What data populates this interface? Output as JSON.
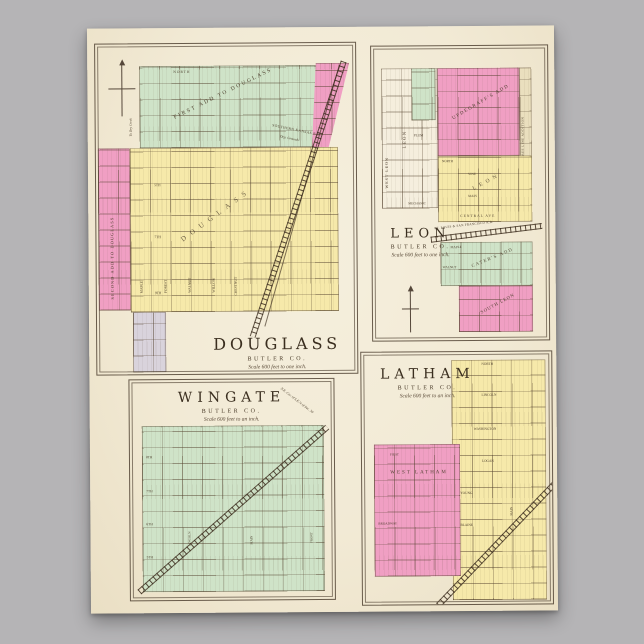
{
  "palette": {
    "background": "#b5b4b6",
    "paper": "#f2ead5",
    "green": "#cfe3c8",
    "yellow": "#f6e9aa",
    "pink": "#f09fc3",
    "lavender": "#d9d3dc",
    "ink": "#5a4a38"
  },
  "poster": {
    "douglass": {
      "title": "DOUGLASS",
      "county": "BUTLER CO.",
      "scale": "Scale 600 feet to one inch.",
      "labels": {
        "first_add": "FIRST ADD TO DOUGLASS",
        "second_add": "SECOND ADD TO DOUGLASS",
        "original": "DOUGLASS",
        "railroad": "SOUTHERN KANSAS R.R.",
        "depot": "Dep. Grounds",
        "north": "NORTH",
        "note": "To Dry Creek"
      },
      "streets": [
        "MAPLE",
        "FOREST",
        "WALNUT",
        "WILLOW",
        "CHESTNUT",
        "5TH",
        "7TH",
        "9TH"
      ]
    },
    "leon": {
      "title": "LEON",
      "county": "BUTLER CO.",
      "scale": "Scale 600 feet to one inch.",
      "labels": {
        "west_leon": "WEST LEON",
        "leon_vertical": "LEON",
        "updegraffs_add": "UPDEGRAFF'S ADD",
        "bee_line": "BEE LINE ADDITION",
        "original": "LEON",
        "caters_add": "CATER'S ADD",
        "south_leon": "SOUTH LEON",
        "railroad": "ST. LOUIS & SAN FRANCISCO R.R."
      },
      "streets": [
        "PLUM",
        "NORTH",
        "VINE",
        "MAIN",
        "MECHANIC",
        "CENTRAL AVE",
        "MAPLE",
        "WALNUT"
      ]
    },
    "wingate": {
      "title": "WINGATE",
      "county": "BUTLER CO.",
      "scale": "Scale 600 feet to an inch.",
      "labels": {
        "corner_note": "N.E. Cor. of S.E.¼ of Sec. 30"
      },
      "streets": [
        "8TH",
        "7TH",
        "6TH",
        "5TH",
        "LINCOLN",
        "MAIN",
        "FRONT"
      ]
    },
    "latham": {
      "title": "LATHAM",
      "county": "BUTLER CO.",
      "scale": "Scale 600 feet to an inch.",
      "labels": {
        "west_latham": "WEST LATHAM"
      },
      "streets": [
        "NORTH",
        "LINCOLN",
        "WASHINGTON",
        "LOGAN",
        "YOUNG",
        "BLAINE",
        "MAIN",
        "FIRST",
        "BROADWAY"
      ]
    }
  }
}
